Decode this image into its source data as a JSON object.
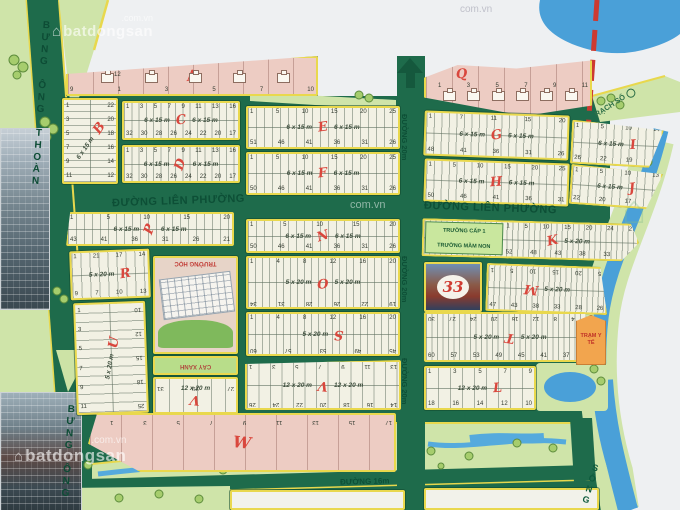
{
  "map": {
    "colors": {
      "road_green": "#1e6b4b",
      "block_cream": "#f2f1e4",
      "block_pink": "#edccc3",
      "light_green": "#cfe4a9",
      "river_blue": "#4aa0d8",
      "letter_red": "#d9473d",
      "border_yellow": "#e9d84d",
      "dashed_red": "#cd3a31",
      "clinic_orange": "#f2a54e"
    },
    "watermark": {
      "brand": "batdongsan",
      "domain": ".com.vn",
      "domain_short": "com.vn",
      "house_icon": "⌂"
    },
    "roads": {
      "lien_phuong": "ĐƯỜNG LIÊN PHƯỜNG",
      "d20": "ĐƯỜNG 20m",
      "d16": "ĐƯỜNG 16m",
      "bung_ong_thoan": "BƯNG ÔNG THOÀN",
      "song": "SÔNG",
      "rach": "RẠCH SỐ"
    },
    "blocks": [
      {
        "id": "A",
        "letter": "A",
        "pink": true,
        "houses": 5,
        "top": [
          "12"
        ],
        "bottom": [
          "9",
          "1",
          "3",
          "5",
          "7",
          "10"
        ]
      },
      {
        "id": "Q",
        "letter": "Q",
        "pink": true,
        "houses": 6,
        "top": [
          "1",
          "3",
          "5",
          "7",
          "9",
          "11"
        ]
      },
      {
        "id": "B",
        "letter": "B",
        "vertical": true,
        "sizes": [
          "6 x 15 m"
        ],
        "left_col": [
          "1",
          "3",
          "5",
          "7",
          "9",
          "11"
        ],
        "right_col": [
          "22",
          "20",
          "18",
          "16",
          "14",
          "12"
        ],
        "tworow": true
      },
      {
        "id": "C",
        "letter": "C",
        "sizes": [
          "6 x 15 m",
          "6 x 15 m"
        ],
        "top": [
          "1",
          "3",
          "5",
          "7",
          "9",
          "11",
          "13",
          "16"
        ],
        "bottom": [
          "32",
          "30",
          "28",
          "26",
          "24",
          "22",
          "20",
          "17"
        ],
        "tworow": true
      },
      {
        "id": "D",
        "letter": "D",
        "sizes": [
          "6 x 15 m",
          "6 x 15 m"
        ],
        "top": [
          "1",
          "3",
          "5",
          "7",
          "9",
          "11",
          "13",
          "16"
        ],
        "bottom": [
          "32",
          "30",
          "28",
          "26",
          "24",
          "22",
          "20",
          "17"
        ],
        "tworow": true
      },
      {
        "id": "E",
        "letter": "E",
        "sizes": [
          "6 x 15 m",
          "6 x 15 m"
        ],
        "top": [
          "1",
          "5",
          "10",
          "15",
          "20",
          "25"
        ],
        "bottom": [
          "51",
          "46",
          "41",
          "36",
          "31",
          "26"
        ],
        "tworow": true
      },
      {
        "id": "F",
        "letter": "F",
        "sizes": [
          "6 x 15 m",
          "6 x 15 m"
        ],
        "top": [
          "1",
          "5",
          "10",
          "15",
          "20",
          "25"
        ],
        "bottom": [
          "50",
          "46",
          "41",
          "36",
          "31",
          "26"
        ],
        "tworow": true
      },
      {
        "id": "G",
        "letter": "G",
        "sizes": [
          "6 x 15 m",
          "6 x 15 m"
        ],
        "top": [
          "1",
          "7",
          "11",
          "15",
          "20"
        ],
        "bottom": [
          "48",
          "41",
          "36",
          "31",
          "26"
        ],
        "tworow": true
      },
      {
        "id": "H",
        "letter": "H",
        "sizes": [
          "6 x 15 m",
          "6 x 15 m"
        ],
        "top": [
          "1",
          "5",
          "10",
          "15",
          "20",
          "25"
        ],
        "bottom": [
          "50",
          "46",
          "41",
          "36",
          "31"
        ],
        "tworow": true
      },
      {
        "id": "I",
        "letter": "I",
        "sizes": [
          "6 x 15 m"
        ],
        "top": [
          "1",
          "5",
          "10",
          "14"
        ],
        "bottom": [
          "26",
          "22",
          "19",
          "15"
        ],
        "tworow": true
      },
      {
        "id": "J",
        "letter": "J",
        "sizes": [
          "6 x 15 m"
        ],
        "top": [
          "1",
          "5",
          "10",
          "13"
        ],
        "bottom": [
          "22",
          "20",
          "17",
          "14"
        ],
        "tworow": true
      },
      {
        "id": "P",
        "letter": "P",
        "sizes": [
          "6 x 15 m",
          "6 x 15 m"
        ],
        "top": [
          "1",
          "5",
          "10",
          "15",
          "20"
        ],
        "bottom": [
          "43",
          "41",
          "36",
          "31",
          "26",
          "21"
        ],
        "tworow": true
      },
      {
        "id": "N",
        "letter": "N",
        "sizes": [
          "6 x 15 m",
          "6 x 15 m"
        ],
        "top": [
          "1",
          "5",
          "10",
          "15",
          "20"
        ],
        "bottom": [
          "50",
          "46",
          "41",
          "36",
          "31",
          "26"
        ],
        "tworow": true
      },
      {
        "id": "K",
        "letter": "K",
        "sizes": [
          "5 x 20 m"
        ],
        "top": [
          "1",
          "5",
          "10",
          "15",
          "20",
          "24",
          "27"
        ],
        "bottom": [
          "52",
          "48",
          "43",
          "38",
          "33",
          "28"
        ],
        "tworow": true,
        "sub": [
          "TRƯỜNG CẤP 1",
          "TRƯỜNG MẦM NON"
        ]
      },
      {
        "id": "R",
        "letter": "R",
        "sizes": [
          "5 x 20 m"
        ],
        "top": [
          "1",
          "21",
          "17",
          "14"
        ],
        "bottom": [
          "9",
          "7",
          "10",
          "13"
        ],
        "tworow": true
      },
      {
        "id": "O",
        "letter": "O",
        "sizes": [
          "5 x 20 m",
          "5 x 20 m"
        ],
        "top": [
          "1",
          "4",
          "8",
          "12",
          "16",
          "20"
        ],
        "bottom": [
          "19",
          "22",
          "26",
          "28",
          "31",
          "34"
        ],
        "flip_bottom": true,
        "tworow": true
      },
      {
        "id": "AD",
        "type": "billboard",
        "billboard": "33"
      },
      {
        "id": "M",
        "letter": "M",
        "sizes": [
          "5 x 20 m"
        ],
        "top": [
          "25",
          "20",
          "15",
          "10",
          "5",
          "1"
        ],
        "flip_top": true,
        "bottom": [
          "47",
          "43",
          "38",
          "33",
          "28",
          "26"
        ],
        "tworow": true
      },
      {
        "id": "U",
        "letter": "U",
        "vertical": true,
        "sizes": [
          "5 x 20 m"
        ],
        "left_col": [
          "1",
          "3",
          "5",
          "7",
          "9",
          "11"
        ],
        "right_col": [
          "25",
          "18",
          "15",
          "12",
          "10"
        ],
        "flip_right": true,
        "tworow": true
      },
      {
        "id": "SCH",
        "type": "school",
        "label": "TRƯỜNG HỌC"
      },
      {
        "id": "CX",
        "type": "greenarea",
        "label": "CÂY XANH"
      },
      {
        "id": "V1",
        "letter": "V",
        "sizes": [
          "12 x 20 m"
        ],
        "top": [
          "27",
          "29",
          "31"
        ],
        "flip_top": true
      },
      {
        "id": "S",
        "letter": "S",
        "sizes": [
          "5 x 20 m"
        ],
        "top": [
          "1",
          "4",
          "8",
          "12",
          "16",
          "20"
        ],
        "bottom": [
          "45",
          "49",
          "53",
          "57",
          "60"
        ],
        "flip_bottom": true,
        "tworow": true
      },
      {
        "id": "T",
        "letter": "T",
        "sizes": [
          "5 x 20 m",
          "5 x 20 m"
        ],
        "top": [
          "1",
          "4",
          "8",
          "12",
          "16",
          "20",
          "24",
          "27",
          "30"
        ],
        "flip_top": true,
        "bottom": [
          "60",
          "57",
          "53",
          "49",
          "45",
          "41",
          "37",
          "31"
        ],
        "tworow": true
      },
      {
        "id": "V2",
        "letter": "V",
        "sizes": [
          "12 x 20 m",
          "12 x 20 m"
        ],
        "top": [
          "13",
          "11",
          "9",
          "7",
          "5",
          "3",
          "1"
        ],
        "flip_top": true,
        "bottom": [
          "14",
          "16",
          "18",
          "20",
          "22",
          "24",
          "26"
        ],
        "flip_bottom": true,
        "tworow": true
      },
      {
        "id": "L",
        "letter": "L",
        "sizes": [
          "12 x 20 m"
        ],
        "top": [
          "1",
          "3",
          "5",
          "7",
          "9"
        ],
        "bottom": [
          "18",
          "16",
          "14",
          "12",
          "10"
        ],
        "tworow": true
      },
      {
        "id": "YT",
        "type": "clinic",
        "label": "TRẠM Y TẾ"
      },
      {
        "id": "W",
        "letter": "W",
        "pink": true,
        "top": [
          "17",
          "15",
          "13",
          "11",
          "9",
          "7",
          "5",
          "3",
          "1"
        ],
        "flip_top": true
      },
      {
        "id": "X1",
        "type": "plain"
      },
      {
        "id": "X2",
        "type": "plain"
      }
    ]
  }
}
